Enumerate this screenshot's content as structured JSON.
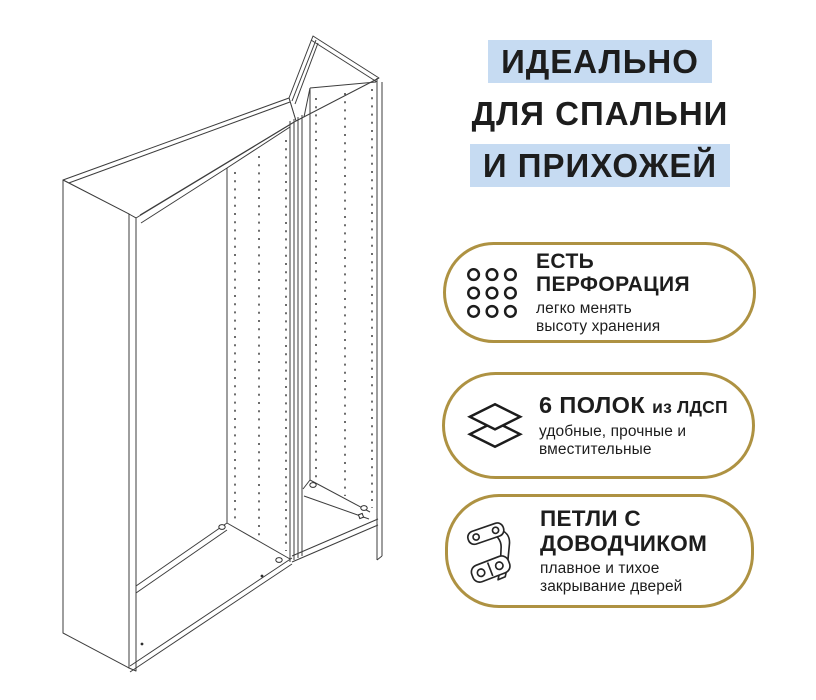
{
  "headline": {
    "lines": [
      {
        "text": "ИДЕАЛЬНО",
        "highlighted": true
      },
      {
        "text": "ДЛЯ СПАЛЬНИ",
        "highlighted": false
      },
      {
        "text": "И ПРИХОЖЕЙ",
        "highlighted": true
      }
    ]
  },
  "features": [
    {
      "icon": "perforation-grid-icon",
      "title_line1": "ЕСТЬ",
      "title_line2": "ПЕРФОРАЦИЯ",
      "subtitle_line1": "легко менять",
      "subtitle_line2": "высоту хранения"
    },
    {
      "icon": "shelf-layers-icon",
      "title_strong": "6 ПОЛОК",
      "title_rest": "из ЛДСП",
      "subtitle_line1": "удобные, прочные и",
      "subtitle_line2": "вместительные"
    },
    {
      "icon": "soft-close-hinge-icon",
      "title_line1": "ПЕТЛИ С",
      "title_line2": "ДОВОДЧИКОМ",
      "subtitle_line1": "плавное и тихое",
      "subtitle_line2": "закрывание дверей"
    }
  ],
  "illustration": {
    "name": "wardrobe-frame-line-drawing",
    "description": "Изометрический контурный чертёж двух открытых каркасов шкафа с рядами перфорации"
  },
  "colors": {
    "gold": "#ae9242",
    "blue": "#c6dbf2",
    "text": "#1d1d1d",
    "line": "#3d3d3d",
    "bg": "#ffffff"
  }
}
